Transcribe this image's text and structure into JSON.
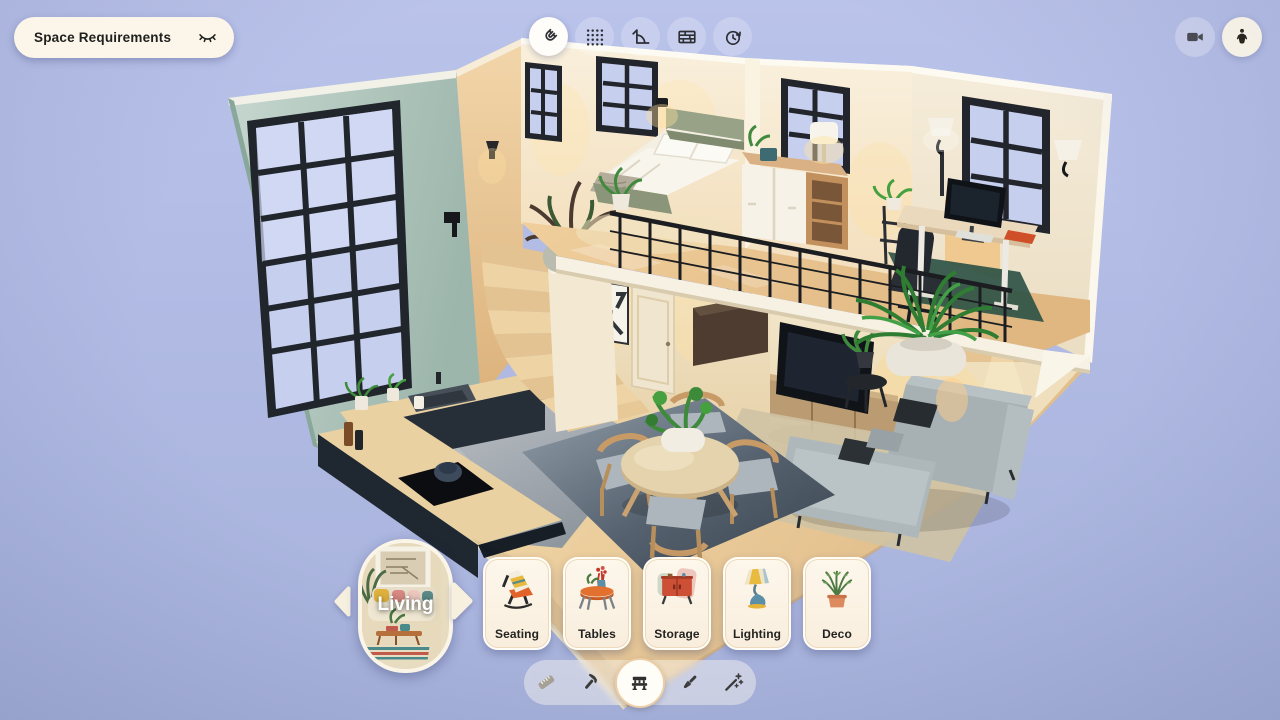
{
  "top_bar": {
    "space_requirements_button": {
      "label": "Space Requirements",
      "icon": "closed-eye-icon"
    },
    "tool_buttons": [
      {
        "id": "snap",
        "icon": "magnet-icon",
        "active": true
      },
      {
        "id": "layout-grid",
        "icon": "dots-grid-icon",
        "active": false
      },
      {
        "id": "measure-angle",
        "icon": "angle-ruler-icon",
        "active": false
      },
      {
        "id": "materials",
        "icon": "brick-wall-icon",
        "active": false
      },
      {
        "id": "history",
        "icon": "clock-rotate-icon",
        "active": false
      }
    ],
    "view_buttons": [
      {
        "id": "camera-view",
        "icon": "video-camera-icon"
      },
      {
        "id": "walk-mode",
        "icon": "person-icon"
      }
    ]
  },
  "carousel": {
    "selected_room": "Living",
    "prev_icon": "chevron-left-arrow",
    "next_icon": "chevron-right-arrow",
    "categories": [
      {
        "label": "Seating",
        "illustration": "lounge-chair"
      },
      {
        "label": "Tables",
        "illustration": "round-table-with-vase"
      },
      {
        "label": "Storage",
        "illustration": "red-cabinet"
      },
      {
        "label": "Lighting",
        "illustration": "table-lamp"
      },
      {
        "label": "Deco",
        "illustration": "potted-plant"
      }
    ]
  },
  "bottom_toolbar": {
    "tools": [
      {
        "id": "measure",
        "icon": "tape-measure-icon",
        "state": "disabled"
      },
      {
        "id": "build",
        "icon": "hammer-icon",
        "state": "default"
      },
      {
        "id": "furnish",
        "icon": "bench-icon",
        "state": "active"
      },
      {
        "id": "paint",
        "icon": "paint-brush-icon",
        "state": "default"
      },
      {
        "id": "auto-style",
        "icon": "magic-wand-icon",
        "state": "default"
      }
    ]
  },
  "scene": {
    "description": "Isometric cut-away 3D render of a two-storey loft: kitchen with dark cabinets, round dining table on a slate rug, grey sectional sofa with TV, winding wooden staircase, mezzanine bedroom and desk nook behind a black metal railing, tall sage wall with industrial window grid.",
    "colors": {
      "sky": "#aeb8e0",
      "teal_wall": "#b3cbc1",
      "cream_wall": "#f4ead5",
      "wood_floor": "#e9cb9b",
      "kitchen_cabinets": "#232b35",
      "sofa": "#adb6b9",
      "dining_rug": "#46525f",
      "desk_rug": "#2e5246",
      "railing": "#1b1d21"
    }
  }
}
